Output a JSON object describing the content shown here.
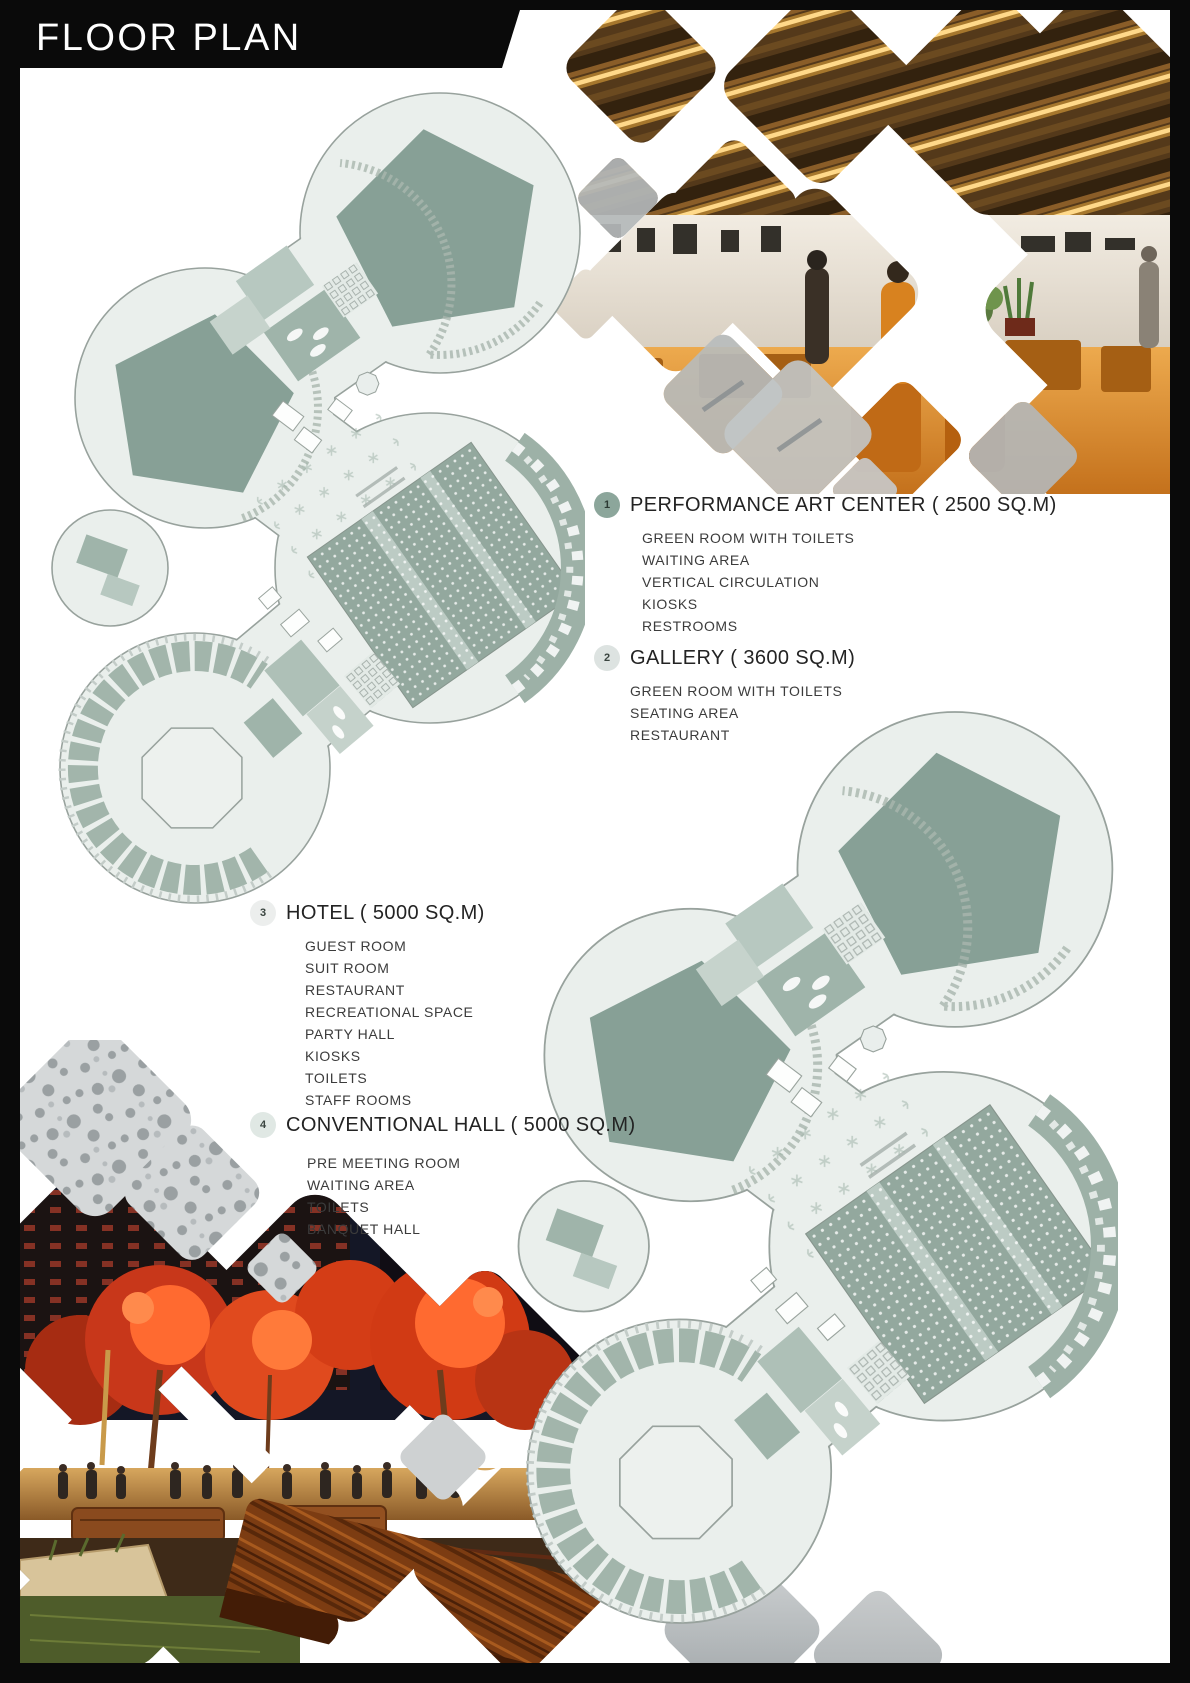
{
  "page": {
    "title": "FLOOR PLAN"
  },
  "palette": {
    "frame": "#0a0a0a",
    "plan_floor": "#eaefec",
    "plan_outline": "#98a29d",
    "pentagon_sage": "#87a096",
    "panel_sage": "#9fb4aa",
    "panel_sage_light": "#c6d3cc",
    "badge_1": "#8ca69b",
    "badge_2": "#dde3e1",
    "badge_3": "#eceeed",
    "badge_4": "#e0e8e4",
    "interior_gold": "#f3bd5e",
    "interior_orange": "#d8821f",
    "night_red": "#d63a16"
  },
  "legend": {
    "sections": [
      {
        "badge": "1",
        "label": "PERFORMANCE ART CENTER ( 2500 SQ.M)",
        "items": [
          "GREEN ROOM WITH TOILETS",
          "WAITING AREA",
          "VERTICAL CIRCULATION",
          "KIOSKS",
          "RESTROOMS"
        ]
      },
      {
        "badge": "2",
        "label": "GALLERY ( 3600 SQ.M)",
        "items": [
          "GREEN ROOM WITH TOILETS",
          "SEATING AREA",
          "RESTAURANT"
        ]
      },
      {
        "badge": "3",
        "label": "HOTEL ( 5000 SQ.M)",
        "items": [
          "GUEST ROOM",
          "SUIT ROOM",
          "RESTAURANT",
          "RECREATIONAL SPACE",
          "PARTY HALL",
          "KIOSKS",
          "TOILETS",
          "STAFF ROOMS"
        ]
      },
      {
        "badge": "4",
        "label": "CONVENTIONAL HALL ( 5000 SQ.M)",
        "items": [
          "PRE MEETING ROOM",
          "WAITING AREA",
          "TOILETS",
          "BANQUET HALL"
        ]
      }
    ]
  }
}
